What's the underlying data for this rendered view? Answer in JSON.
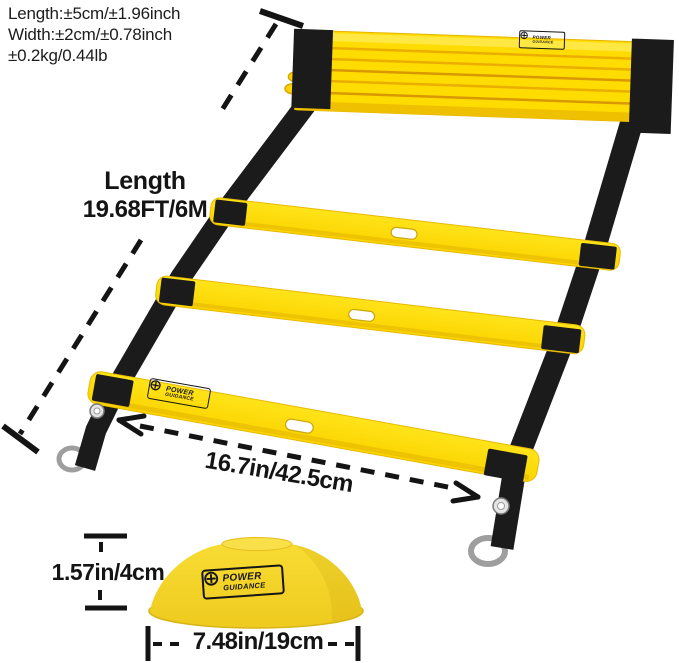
{
  "annotations": {
    "tolerance_lines": [
      "Length:±5cm/±1.96inch",
      "Width:±2cm/±0.78inch",
      "±0.2kg/0.44lb"
    ],
    "length_title": "Length",
    "length_value": "19.68FT/6M",
    "rung_width": "16.7in/42.5cm",
    "cone_height": "1.57in/4cm",
    "cone_diameter": "7.48in/19cm"
  },
  "brand": {
    "line1": "POWER",
    "line2": "GUIDANCE"
  },
  "colors": {
    "ladder_yellow": "#FFDC00",
    "rung_edge": "#E3AE00",
    "strap_black": "#1B1B1B",
    "cone_yellow": "#F2D32A",
    "metal_gray": "#9E9E9E",
    "annotation_black": "#141414",
    "background": "#FFFFFF"
  }
}
